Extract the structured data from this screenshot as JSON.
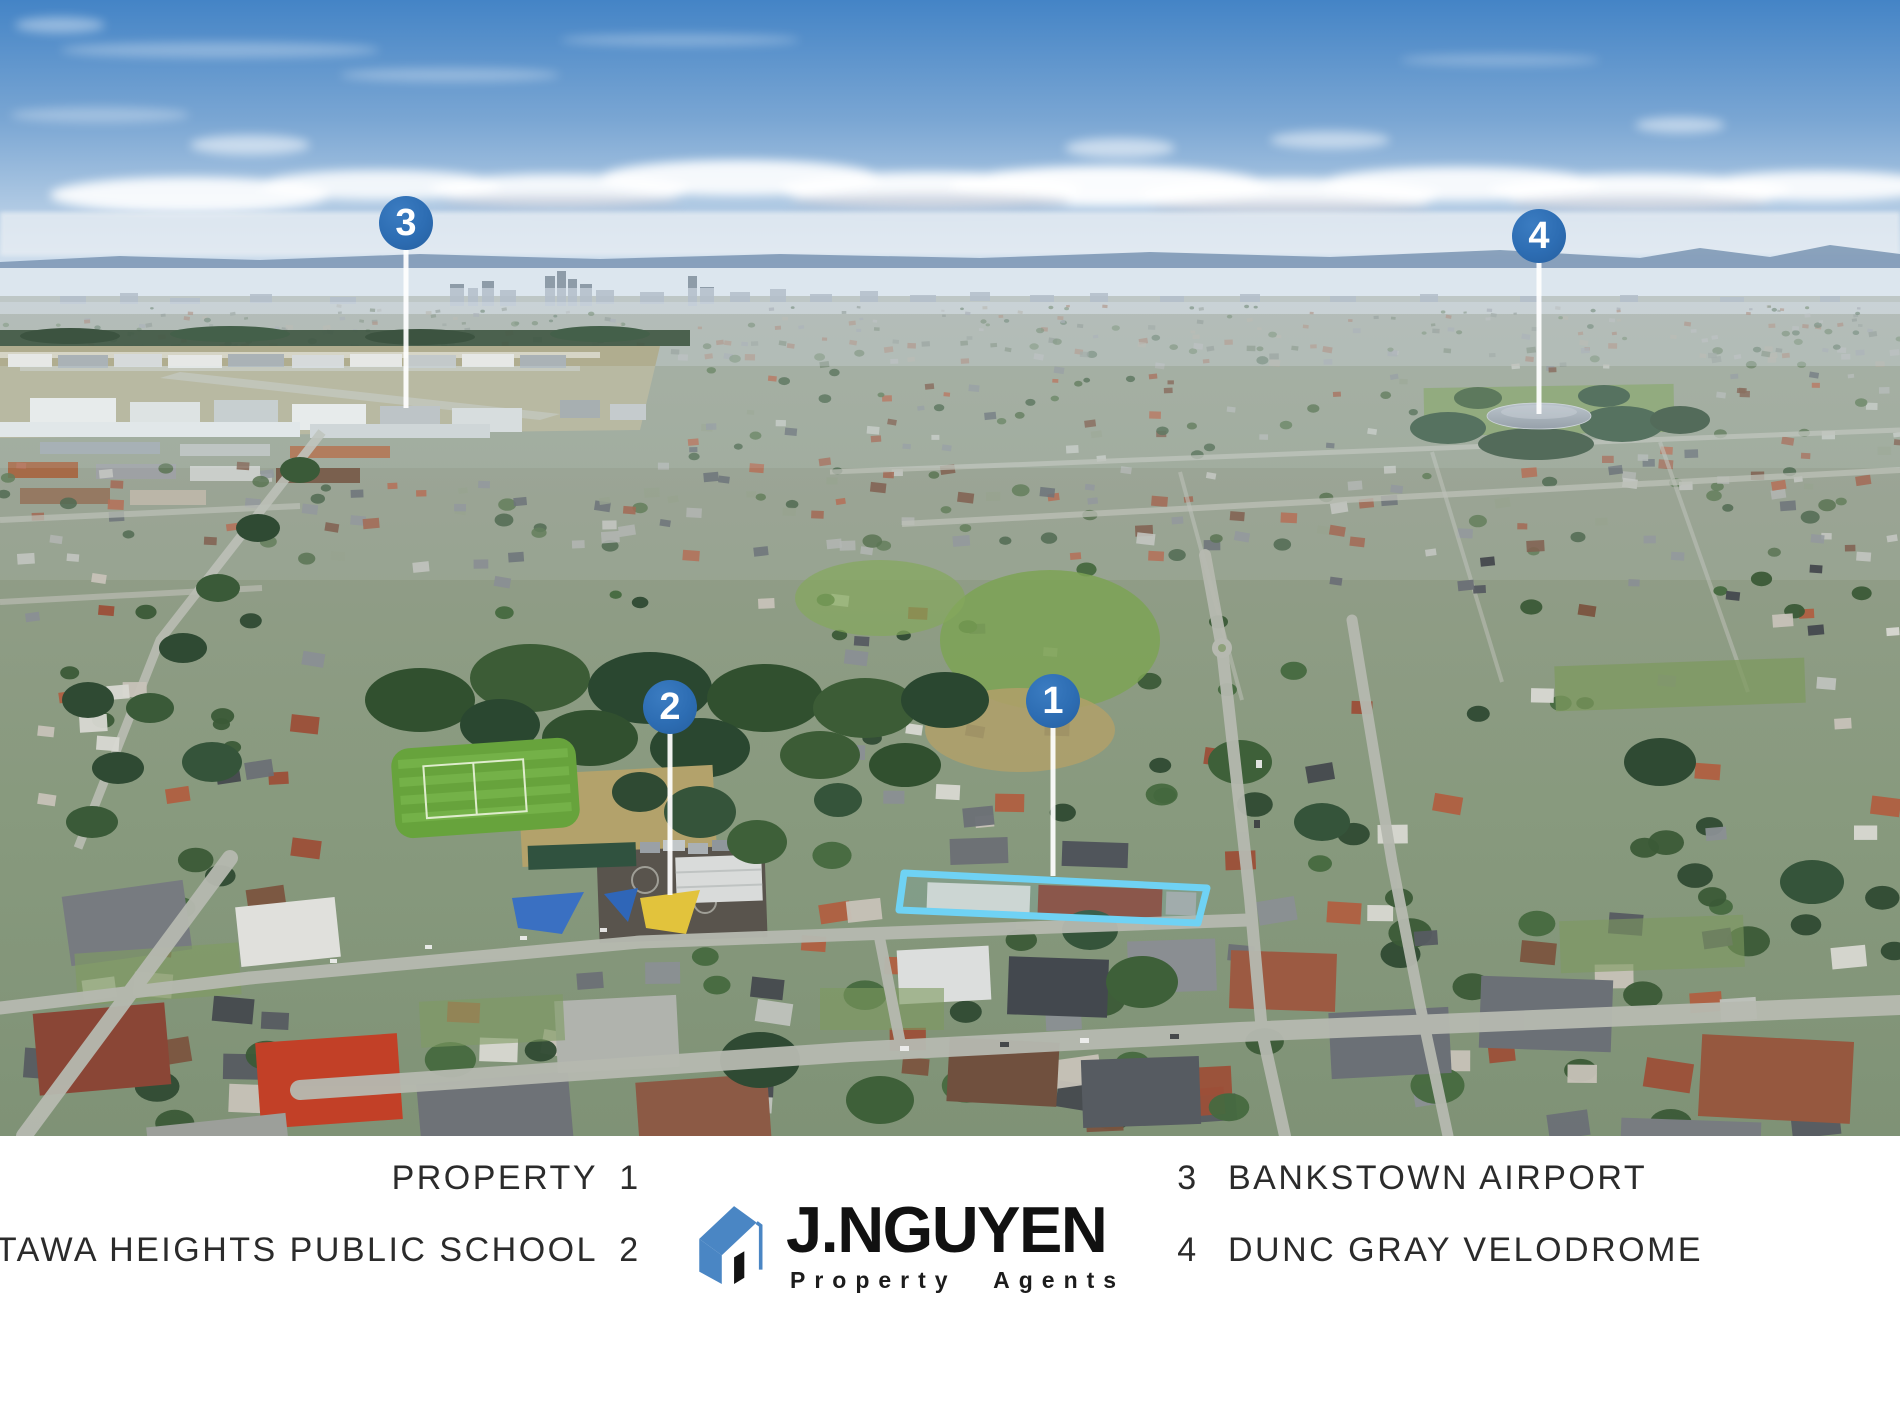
{
  "photo": {
    "markers": [
      {
        "number": "1"
      },
      {
        "number": "2"
      },
      {
        "number": "3"
      },
      {
        "number": "4"
      }
    ],
    "marker_color": "#2d6db3",
    "stem_color": "#ffffff",
    "property_outline_color": "#6fd2f4",
    "sky_color": "#4484c6"
  },
  "legend": {
    "left": [
      {
        "label": "PROPERTY",
        "number": "1"
      },
      {
        "label": "ATTAWA HEIGHTS PUBLIC SCHOOL",
        "number": "2"
      }
    ],
    "right": [
      {
        "number": "3",
        "label": "BANKSTOWN AIRPORT"
      },
      {
        "number": "4",
        "label": "DUNC GRAY VELODROME"
      }
    ],
    "text_color": "#2b2b2b"
  },
  "logo": {
    "name": "J.NGUYEN",
    "tagline": "Property Agents",
    "house_color": "#4a86c4",
    "text_color": "#111111"
  }
}
